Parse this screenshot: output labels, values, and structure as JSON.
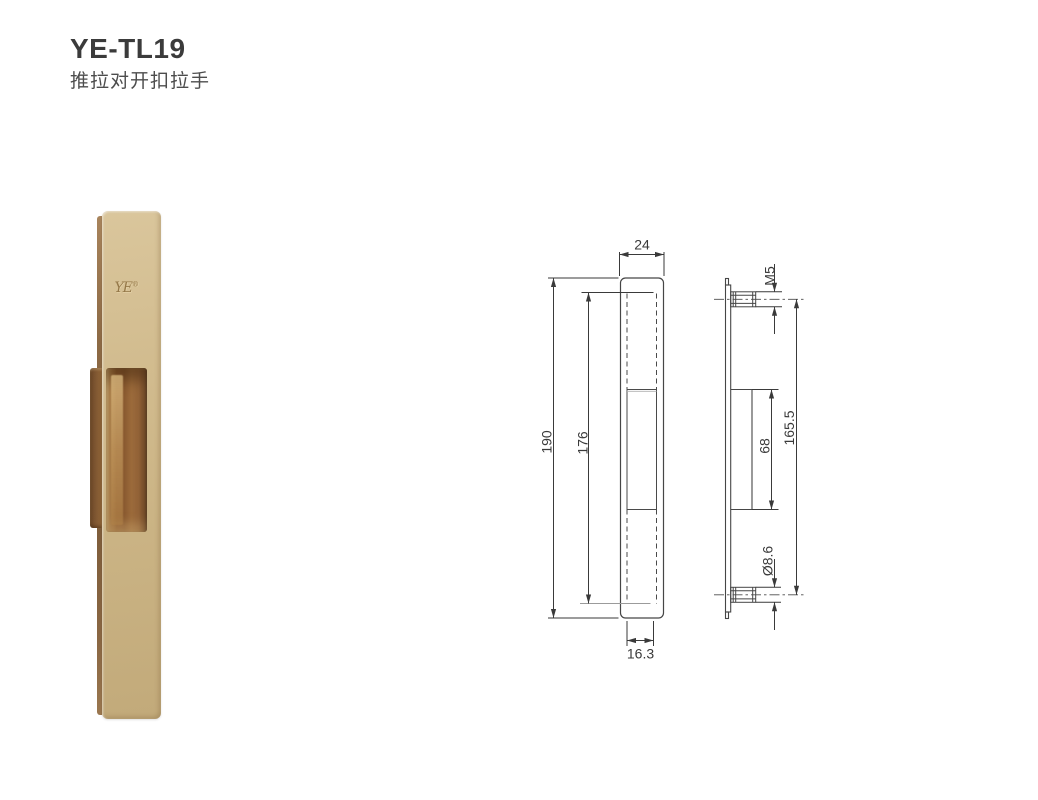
{
  "header": {
    "title": "YE-TL19",
    "subtitle": "推拉对开扣拉手"
  },
  "photo": {
    "logo_text": "YE",
    "logo_reg": "®",
    "finish_color": "#ccb485",
    "pocket_color": "#8a5a30"
  },
  "drawing": {
    "line_color": "#464646",
    "front_view": {
      "width": "24",
      "height": "190",
      "recess_height": "176",
      "recess_width": "16.3"
    },
    "side_view": {
      "thread": "M5",
      "hole_centers": "165.5",
      "pocket_height": "68",
      "boss_diameter": "Ø8.6"
    }
  }
}
